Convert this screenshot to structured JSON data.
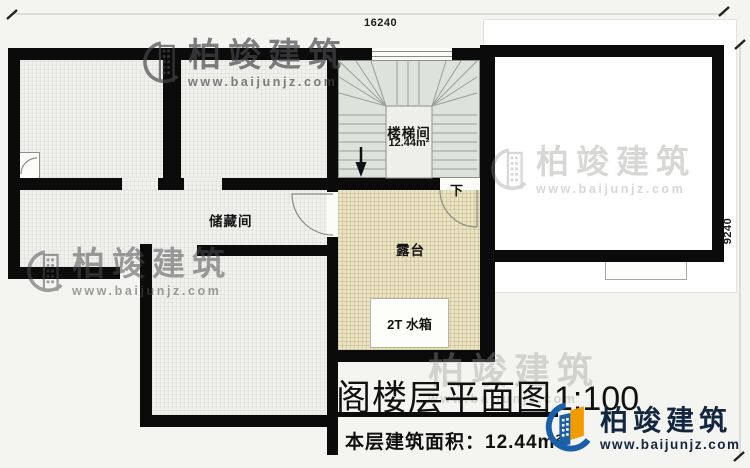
{
  "plan": {
    "dim_top": "16240",
    "dim_right": "9240",
    "room_storage": "储藏间",
    "room_stair": "楼梯间",
    "stair_area": "12.44m²",
    "room_terrace": "露台",
    "water_tank": "2T 水箱",
    "stair_down": "下",
    "title": "阁楼层平面图",
    "scale": "1:100",
    "area_note": "本层建筑面积：12.44m²"
  },
  "watermark": {
    "brand": "柏竣建筑",
    "site": "www.baijunjz.com"
  },
  "logo": {
    "brand": "柏竣建筑",
    "site": "www.baijunjz.com"
  },
  "colors": {
    "wall": "#0b0b0b",
    "stair_floor": "#dde3da",
    "terrace_floor": "#ebe3c6",
    "logo_blue": "#1a5fa8",
    "logo_orange": "#f29b00",
    "logo_navy": "#13263f"
  }
}
